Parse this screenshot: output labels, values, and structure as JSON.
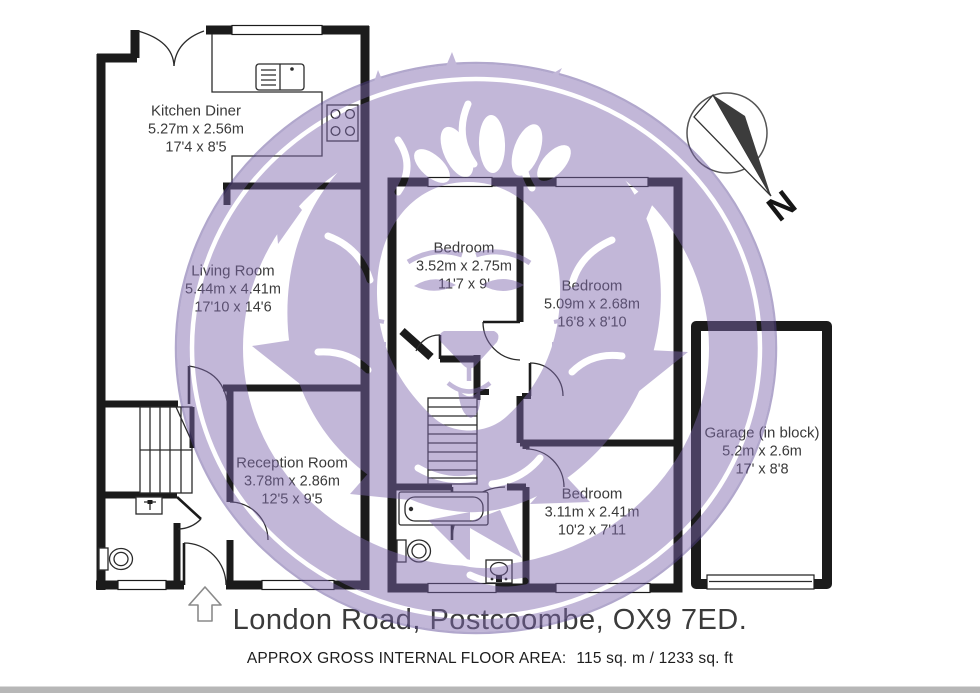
{
  "colors": {
    "watermark_purple": "#7e68ae",
    "wall": "#1b1b1b",
    "label_text": "#3a3a3a",
    "footer_text": "#3b3b3b"
  },
  "compass": {
    "north_label": "N"
  },
  "rooms": [
    {
      "name": "Kitchen Diner",
      "metric": "5.27m x 2.56m",
      "imperial": "17'4 x 8'5"
    },
    {
      "name": "Living Room",
      "metric": "5.44m x 4.41m",
      "imperial": "17'10 x 14'6"
    },
    {
      "name": "Reception Room",
      "metric": "3.78m x 2.86m",
      "imperial": "12'5 x 9'5"
    },
    {
      "name": "Bedroom",
      "metric": "3.52m x 2.75m",
      "imperial": "11'7 x 9'"
    },
    {
      "name": "Bedroom",
      "metric": "5.09m x 2.68m",
      "imperial": "16'8 x 8'10"
    },
    {
      "name": "Bedroom",
      "metric": "3.11m x 2.41m",
      "imperial": "10'2 x 7'11"
    },
    {
      "name": "Garage (in block)",
      "metric": "5.2m x 2.6m",
      "imperial": "17' x 8'8"
    }
  ],
  "footer": {
    "address": "London Road, Postcoombe, OX9 7ED.",
    "area_label": "APPROX GROSS INTERNAL FLOOR AREA:",
    "area_value": "115 sq. m / 1233 sq. ft"
  }
}
